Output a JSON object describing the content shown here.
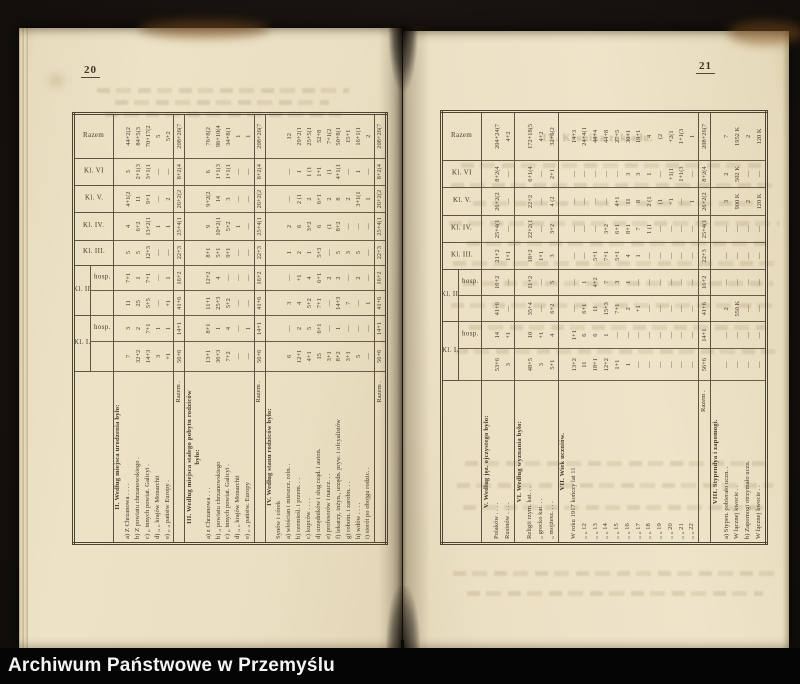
{
  "archive_bar": {
    "label": "Archiwum Państwowe w Przemyślu"
  },
  "left_page": {
    "page_number": "20",
    "table": {
      "col_groups": [
        {
          "label": "Kl. I.",
          "subs": [
            "",
            "hosp."
          ]
        },
        {
          "label": "Kl. II.",
          "subs": [
            "",
            "hosp."
          ]
        }
      ],
      "col_singles": [
        "Kl. III.",
        "Kl. IV.",
        "Kl. V.",
        "Kl. VI",
        "Razem"
      ],
      "sections": [
        {
          "title": "II. Według miejsca urodzenia było:",
          "rows": [
            {
              "label": "a) Z Chrzanowa .  .  .  .",
              "cells": [
                "7",
                "3",
                "11",
                "7+1",
                "5",
                "4",
                "4+1(2",
                "3",
                "44+2(2"
              ]
            },
            {
              "label": "b) Z powiatu chrzanowskiego .",
              "cells": [
                "32+2",
                "2",
                "25",
                "1",
                "5",
                "6+2",
                "11",
                "2+1(3",
                "84+5(3"
              ]
            },
            {
              "label": "c) „ innych powiat. Galicyi .",
              "cells": [
                "14+3",
                "7+1",
                "5+5",
                "7+1",
                "12+3",
                "13+2(1",
                "9+1",
                "3+1(1",
                "70+17(2"
              ]
            },
            {
              "label": "d) „  „  krajów Monarchii",
              "cells": [
                "3",
                "1",
                "—",
                "—",
                "—",
                "1",
                "—",
                "—",
                "5"
              ]
            },
            {
              "label": "e) „  „  państw Europy .",
              "cells": [
                "+1",
                "1",
                "+1",
                "1",
                "—",
                "1",
                "2",
                "—",
                "5+2"
              ]
            },
            {
              "label": "Razem .",
              "kind": "total",
              "cells": [
                "56+6",
                "14+1",
                "41+6",
                "16+2",
                "22+3",
                "25+4(1",
                "26+2(2",
                "8+2(4",
                "208+26(7"
              ]
            }
          ]
        },
        {
          "title": "III. Według miejsca stałego pobytu rodziców",
          "title2": "było:",
          "rows": [
            {
              "label": "a) z Chrzanowa .  .  .",
              "cells": [
                "13+1",
                "8+1",
                "11+1",
                "12+2",
                "8+1",
                "9",
                "9+2(2",
                "6",
                "76+8(2"
              ]
            },
            {
              "label": "b) „ powiatu chrzanowskiego",
              "cells": [
                "36+3",
                "1",
                "25+3",
                "4",
                "5+1",
                "10+2(1",
                "14",
                "1+1(3",
                "96+10(4"
              ]
            },
            {
              "label": "c) „ innych powiat. Galicyi .",
              "cells": [
                "7+2",
                "4",
                "5+2",
                "—",
                "9+1",
                "5+2",
                "3",
                "1+1(1",
                "34+8(1"
              ]
            },
            {
              "label": "d) „  „  krajów Monarchii",
              "cells": [
                "—",
                "—",
                "—",
                "—",
                "—",
                "1",
                "—",
                "—",
                "1"
              ]
            },
            {
              "label": "e) „  „  państw. Europy",
              "cells": [
                "—",
                "1",
                "—",
                "—",
                "—",
                "—",
                "—",
                "—",
                "1"
              ]
            },
            {
              "label": "Razem .",
              "kind": "total",
              "cells": [
                "56+6",
                "14+1",
                "41+6",
                "16+2",
                "22+3",
                "25+4(1",
                "26+2(2",
                "8+2(4",
                "208+26(7"
              ]
            }
          ]
        },
        {
          "title": "IV. Według stanu rodziców było:",
          "rows": [
            {
              "label": "Synów i córek",
              "kind": "sub",
              "cells": [
                "",
                "",
                "",
                "",
                "",
                "",
                "",
                "",
                ""
              ]
            },
            {
              "label": "a) włościan i mieszcz. roln. .",
              "cells": [
                "6",
                "—",
                "3",
                "—",
                "1",
                "2",
                "—",
                "—",
                "12"
              ]
            },
            {
              "label": "b) rzemieśl. i przem. .  .",
              "cells": [
                "12+1",
                "2",
                "4",
                "+1",
                "2",
                "6",
                "2 (1",
                "1",
                "29+2(1"
              ]
            },
            {
              "label": "c) kupców .  .  .  .",
              "cells": [
                "4+1",
                "5",
                "5+2",
                "4",
                "1",
                "3+2",
                "2",
                "1 (1",
                "25+5(1"
              ]
            },
            {
              "label": "d) urzędników i sług rząd. i auton.",
              "cells": [
                "15",
                "6+1",
                "7+1",
                "6+1",
                "5+3",
                "6",
                "6+1",
                "1+1",
                "52+8"
              ]
            },
            {
              "label": "e) profesorów i naucz. .  .",
              "cells": [
                "3+1",
                "—",
                "—",
                "2",
                "—",
                "(1",
                "2",
                "(1",
                "7+1(2"
              ]
            },
            {
              "label": "f) lekarzy, inżyn., urzędn. pryw. i ofcyalistów",
              "cells": [
                "8+2",
                "1",
                "14+3",
                "2",
                "5",
                "8+2",
                "8",
                "4+1(1",
                "50+8(1"
              ]
            },
            {
              "label": "g) robotn. i zarobn. .  .",
              "cells": [
                "3+1",
                "—",
                "7",
                "—",
                "3",
                "—",
                "2",
                "—",
                "15+1"
              ]
            },
            {
              "label": "h) wdów .  .  .  .",
              "cells": [
                "5",
                "—",
                "—",
                "2",
                "5",
                "—",
                "3+1(1",
                "1",
                "16+1(1"
              ]
            },
            {
              "label": "i) sierót po obojgu rodzic. .",
              "cells": [
                "—",
                "—",
                "1",
                "—",
                "—",
                "—",
                "1",
                "—",
                "2"
              ]
            },
            {
              "label": "Razem .",
              "kind": "total",
              "cells": [
                "56+6",
                "14+1",
                "41+6",
                "16+2",
                "22+3",
                "25+4(1",
                "26+2(2",
                "8+2(4",
                "208+26(7"
              ]
            }
          ]
        }
      ]
    }
  },
  "right_page": {
    "page_number": "21",
    "bleed_heading": "IX. Kronika zakładu.",
    "table": {
      "col_groups": [
        {
          "label": "Kl. I.",
          "subs": [
            "",
            "hosp."
          ]
        },
        {
          "label": "Kl. II.",
          "subs": [
            "",
            "hosp."
          ]
        }
      ],
      "col_singles": [
        "Kl. III.",
        "Kl. IV.",
        "Kl. V.",
        "Kl. VI",
        "Razem"
      ],
      "sections": [
        {
          "title": "V. Według jęz. ojczystego było:",
          "rows": [
            {
              "label": "Polaków .  .  .  .",
              "cells": [
                "53+6",
                "14",
                "41+6",
                "16+2",
                "21+2",
                "25+4(1",
                "26+2(2",
                "8+2(4",
                "204+24(7"
              ]
            },
            {
              "label": "Rusinów .  .  .  .",
              "cells": [
                "3",
                "+1",
                "—",
                "—",
                "1+1",
                "—",
                "—",
                "—",
                "4+2"
              ]
            }
          ]
        },
        {
          "title": "VI. Według wyznania było:",
          "rows": [
            {
              "label": "Religii rzym. kat. .  .",
              "cells": [
                "48+5",
                "10",
                "35+4",
                "11+2",
                "18+2",
                "22+2(1",
                "22+2",
                "6+1(4",
                "172+18(5"
              ]
            },
            {
              "label": "„  grecko kat. .  .",
              "cells": [
                "3",
                "+1",
                "—",
                "—",
                "1+1",
                "—",
                "—",
                "—",
                "4+2"
              ]
            },
            {
              "label": "„  mojżesz. .  .  .",
              "cells": [
                "5+1",
                "4",
                "6+2",
                "5",
                "3",
                "3+2",
                "4 (2",
                "2+1",
                "32+6(2"
              ]
            }
          ]
        },
        {
          "title": "VII. Wiek uczniów.",
          "rows": [
            {
              "label": "W roku 1917 kończy lat 11",
              "cells": [
                "13+2",
                "1+1",
                "—",
                "—",
                "—",
                "—",
                "—",
                "—",
                "14+3"
              ]
            },
            {
              "label": "„    „    12",
              "cells": [
                "11",
                "6",
                "6+1",
                "1",
                "—",
                "—",
                "—",
                "—",
                "24+4(1"
              ]
            },
            {
              "label": "„    „    13",
              "cells": [
                "18+1",
                "6",
                "11",
                "4+2",
                "5+1",
                "—",
                "—",
                "—",
                "44+4"
              ]
            },
            {
              "label": "„    „    14",
              "cells": [
                "12+2",
                "1",
                "15+3",
                "7",
                "7+1",
                "3+2",
                "—",
                "—",
                "44+8"
              ]
            },
            {
              "label": "„    „    15",
              "cells": [
                "1+1",
                "—",
                "7+1",
                "3",
                "5+1",
                "6+1",
                "4+1",
                "—",
                "27+5"
              ]
            },
            {
              "label": "„    „    16",
              "cells": [
                "1",
                "—",
                "2",
                "1",
                "4",
                "8+1",
                "11",
                "3",
                "30+1"
              ]
            },
            {
              "label": "„    „    17",
              "cells": [
                "—",
                "—",
                "+1",
                "—",
                "1",
                "7",
                "8",
                "3",
                "19+1"
              ]
            },
            {
              "label": "„    „    18",
              "cells": [
                "—",
                "—",
                "—",
                "—",
                "—",
                "1 (1",
                "2 (1",
                "1",
                "4"
              ]
            },
            {
              "label": "„    „    19",
              "cells": [
                "—",
                "—",
                "—",
                "—",
                "—",
                "—",
                "(1",
                "—",
                "(2"
              ]
            },
            {
              "label": "„    „    20",
              "cells": [
                "—",
                "—",
                "—",
                "—",
                "—",
                "—",
                "+1",
                "+1(1",
                "+2(1"
              ]
            },
            {
              "label": "„    „    21",
              "cells": [
                "—",
                "—",
                "—",
                "—",
                "—",
                "—",
                "—",
                "1+1(3",
                "1+1(3"
              ]
            },
            {
              "label": "„    „    22",
              "cells": [
                "—",
                "—",
                "—",
                "—",
                "—",
                "—",
                "1",
                "—",
                "1"
              ]
            },
            {
              "label": "Razem .",
              "kind": "total",
              "cells": [
                "56+6",
                "14+1",
                "41+6",
                "16+2",
                "22+3",
                "25+4(1",
                "26+2(2",
                "8+2(4",
                "208+26(7"
              ]
            }
          ]
        },
        {
          "title": "VIII. Stypendya i zapomogi.",
          "rows": [
            {
              "label": "a) Stypen. pobierało uczn. .",
              "cells": [
                "—",
                "—",
                "2",
                "—",
                "—",
                "—",
                "3",
                "2",
                "7"
              ]
            },
            {
              "label": "W łącznej kwocie .  .",
              "cells": [
                "—",
                "—",
                "550 K",
                "—",
                "—",
                "—",
                "900 K",
                "502 K",
                "1952 K"
              ]
            },
            {
              "label": "b) Zapomogi otrzymało uczn.",
              "cells": [
                "—",
                "—",
                "—",
                "—",
                "—",
                "—",
                "2",
                "—",
                "2"
              ]
            },
            {
              "label": "W łącznej kwocie .  .",
              "cells": [
                "—",
                "—",
                "—",
                "—",
                "—",
                "—",
                "120 K",
                "—",
                "120 K"
              ]
            }
          ]
        }
      ]
    }
  }
}
